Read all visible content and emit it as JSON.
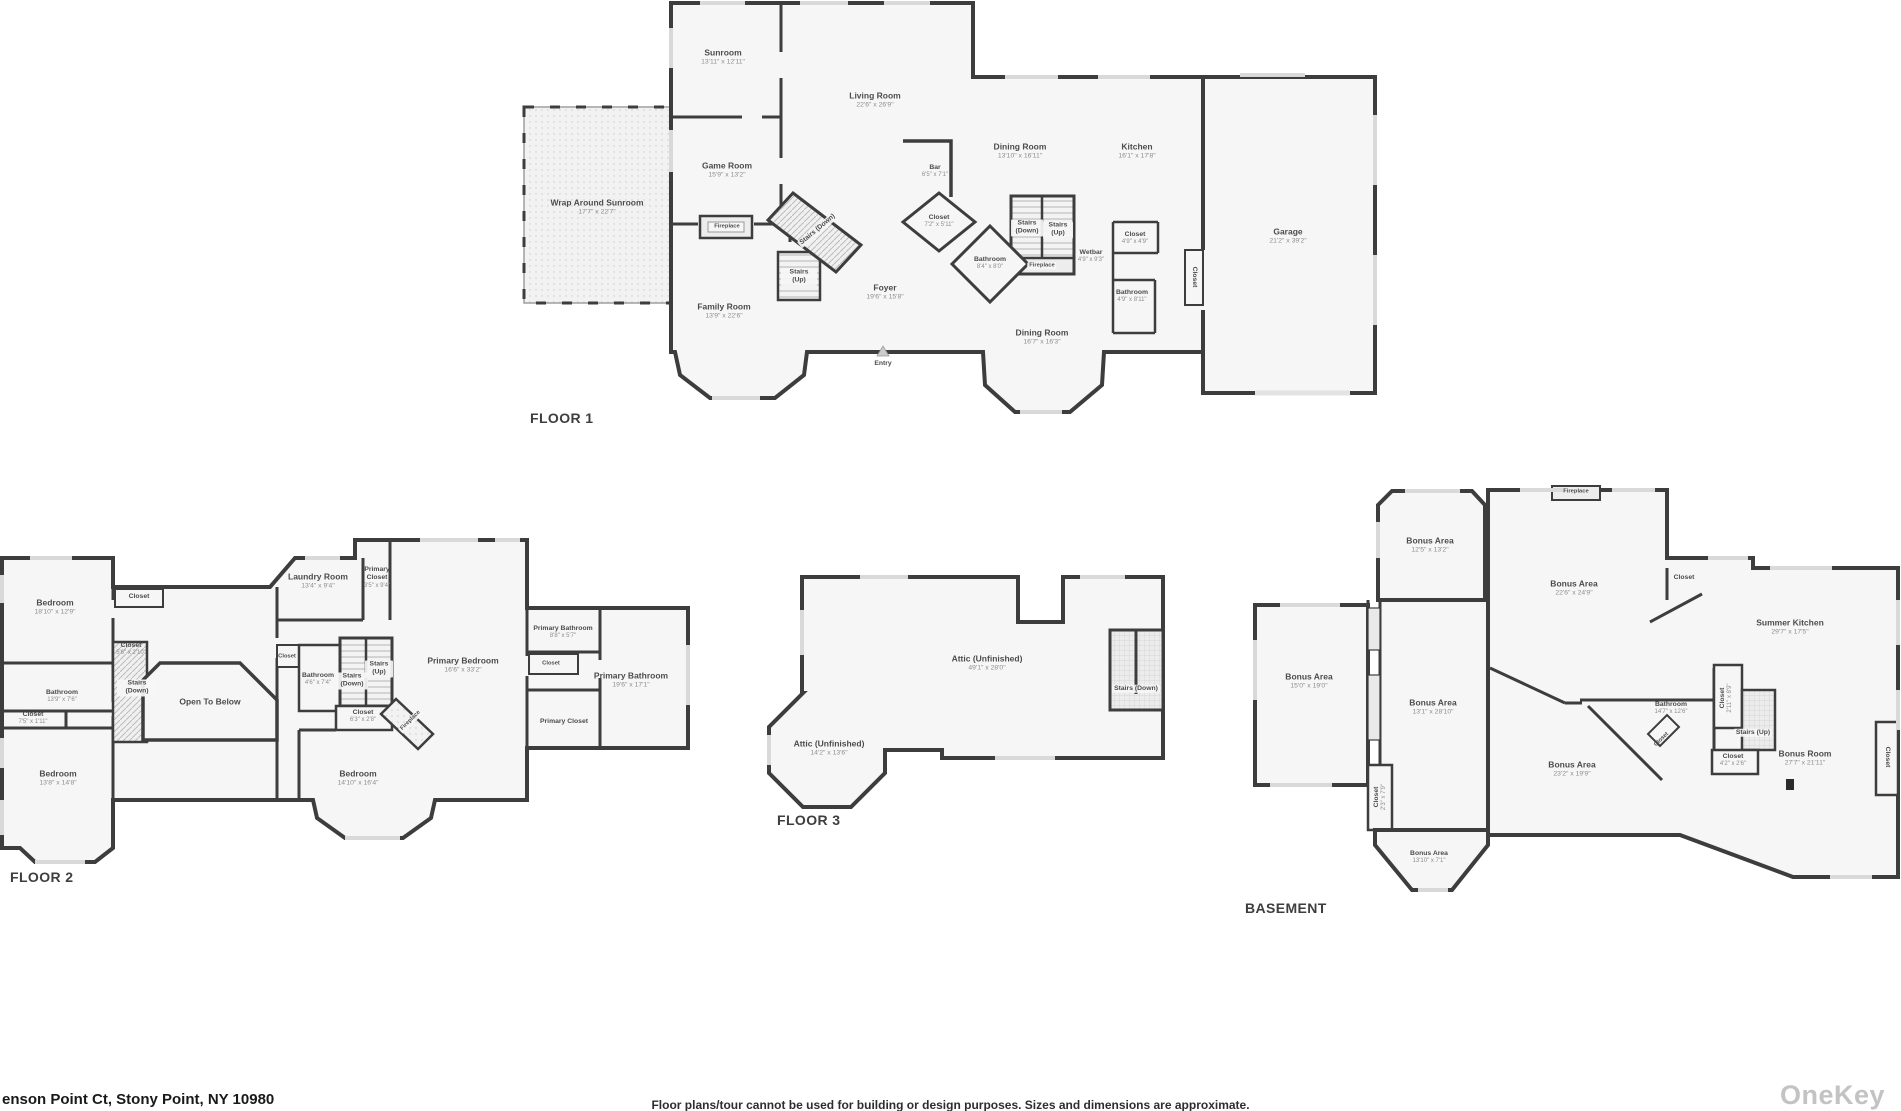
{
  "colors": {
    "wall": "#3d3d3d",
    "room_fill": "#f6f6f6",
    "label_ink": "#4c4c4c",
    "dims_ink": "#8d8d8d",
    "window": "#d9d9d9",
    "watermark": "#c3c3c3"
  },
  "floors": [
    {
      "label": "FLOOR 1",
      "rooms": [
        {
          "name": "Sunroom",
          "dims": "13'11\" x 12'11\""
        },
        {
          "name": "Living Room",
          "dims": "22'6\" x 26'9\""
        },
        {
          "name": "Game Room",
          "dims": "15'9\" x 13'2\""
        },
        {
          "name": "Wrap Around Sunroom",
          "dims": "17'7\" x 22'7\""
        },
        {
          "name": "Fireplace",
          "dims": ""
        },
        {
          "name": "Family Room",
          "dims": "13'9\" x 22'6\""
        },
        {
          "name": "Stairs (Down)",
          "dims": ""
        },
        {
          "name": "Stairs (Up)",
          "dims": ""
        },
        {
          "name": "Foyer",
          "dims": "19'6\" x 15'8\""
        },
        {
          "name": "Entry",
          "dims": ""
        },
        {
          "name": "Bar",
          "dims": "6'5\" x 7'1\""
        },
        {
          "name": "Closet",
          "dims": "7'2\" x 5'11\""
        },
        {
          "name": "Dining Room",
          "dims": "13'10\" x 16'11\""
        },
        {
          "name": "Stairs (Down)",
          "dims": ""
        },
        {
          "name": "Stairs (Up)",
          "dims": ""
        },
        {
          "name": "Fireplace",
          "dims": ""
        },
        {
          "name": "Bathroom",
          "dims": "8'4\" x 8'0\""
        },
        {
          "name": "Wetbar",
          "dims": "4'9\" x 9'3\""
        },
        {
          "name": "Closet",
          "dims": "4'9\" x 4'9\""
        },
        {
          "name": "Bathroom",
          "dims": "4'9\" x 8'11\""
        },
        {
          "name": "Kitchen",
          "dims": "16'1\" x 17'8\""
        },
        {
          "name": "Dining Room",
          "dims": "16'7\" x 16'3\""
        },
        {
          "name": "Closet",
          "dims": ""
        },
        {
          "name": "Garage",
          "dims": "21'2\" x 39'2\""
        }
      ]
    },
    {
      "label": "FLOOR 2",
      "rooms": [
        {
          "name": "Bedroom",
          "dims": "18'10\" x 12'9\""
        },
        {
          "name": "Closet",
          "dims": ""
        },
        {
          "name": "Closet",
          "dims": "5'6\" x 2'10\""
        },
        {
          "name": "Stairs (Down)",
          "dims": ""
        },
        {
          "name": "Open To Below",
          "dims": ""
        },
        {
          "name": "Bathroom",
          "dims": "13'9\" x 7'6\""
        },
        {
          "name": "Closet",
          "dims": "7'5\" x 1'11\""
        },
        {
          "name": "Bedroom",
          "dims": "13'8\" x 14'8\""
        },
        {
          "name": "Laundry Room",
          "dims": "13'4\" x 9'4\""
        },
        {
          "name": "Primary Closet",
          "dims": "3'5\" x 9'4\""
        },
        {
          "name": "Closet",
          "dims": ""
        },
        {
          "name": "Bathroom",
          "dims": "4'6\" x 7'4\""
        },
        {
          "name": "Stairs (Down)",
          "dims": ""
        },
        {
          "name": "Stairs (Up)",
          "dims": ""
        },
        {
          "name": "Closet",
          "dims": "6'3\" x 2'8\""
        },
        {
          "name": "Fireplace",
          "dims": ""
        },
        {
          "name": "Primary Bedroom",
          "dims": "16'6\" x 33'2\""
        },
        {
          "name": "Bedroom",
          "dims": "14'10\" x 16'4\""
        },
        {
          "name": "Primary Bathroom",
          "dims": "8'8\" x 5'7\""
        },
        {
          "name": "Closet",
          "dims": ""
        },
        {
          "name": "Primary Bathroom",
          "dims": "19'6\" x 17'1\""
        },
        {
          "name": "Primary Closet",
          "dims": ""
        }
      ]
    },
    {
      "label": "FLOOR 3",
      "rooms": [
        {
          "name": "Attic (Unfinished)",
          "dims": "49'1\" x 28'0\""
        },
        {
          "name": "Attic (Unfinished)",
          "dims": "14'2\" x 13'6\""
        },
        {
          "name": "Stairs (Down)",
          "dims": ""
        }
      ]
    },
    {
      "label": "BASEMENT",
      "rooms": [
        {
          "name": "Bonus Area",
          "dims": "12'5\" x 13'2\""
        },
        {
          "name": "Fireplace",
          "dims": ""
        },
        {
          "name": "Bonus Area",
          "dims": "22'6\" x 24'9\""
        },
        {
          "name": "Bonus Area",
          "dims": "15'0\" x 19'0\""
        },
        {
          "name": "Bonus Area",
          "dims": "13'1\" x 28'10\""
        },
        {
          "name": "Summer Kitchen",
          "dims": "29'7\" x 17'5\""
        },
        {
          "name": "Closet",
          "dims": ""
        },
        {
          "name": "Bathroom",
          "dims": "14'7\" x 12'6\""
        },
        {
          "name": "Closet",
          "dims": ""
        },
        {
          "name": "Closet",
          "dims": "2'11\" x 8'9\""
        },
        {
          "name": "Stairs (Up)",
          "dims": ""
        },
        {
          "name": "Closet",
          "dims": "4'2\" x 2'6\""
        },
        {
          "name": "Bonus Room",
          "dims": "27'7\" x 21'11\""
        },
        {
          "name": "Closet",
          "dims": ""
        },
        {
          "name": "Bonus Area",
          "dims": "23'2\" x 19'9\""
        },
        {
          "name": "Closet",
          "dims": "2'3\" x 7'9\""
        },
        {
          "name": "Bonus Area",
          "dims": "13'10\" x 7'1\""
        }
      ]
    }
  ],
  "footer": {
    "address": "enson Point Ct, Stony Point, NY 10980",
    "disclaimer": "Floor plans/tour cannot be used for building or design purposes. Sizes and dimensions are approximate.",
    "brand": "OneKey"
  }
}
